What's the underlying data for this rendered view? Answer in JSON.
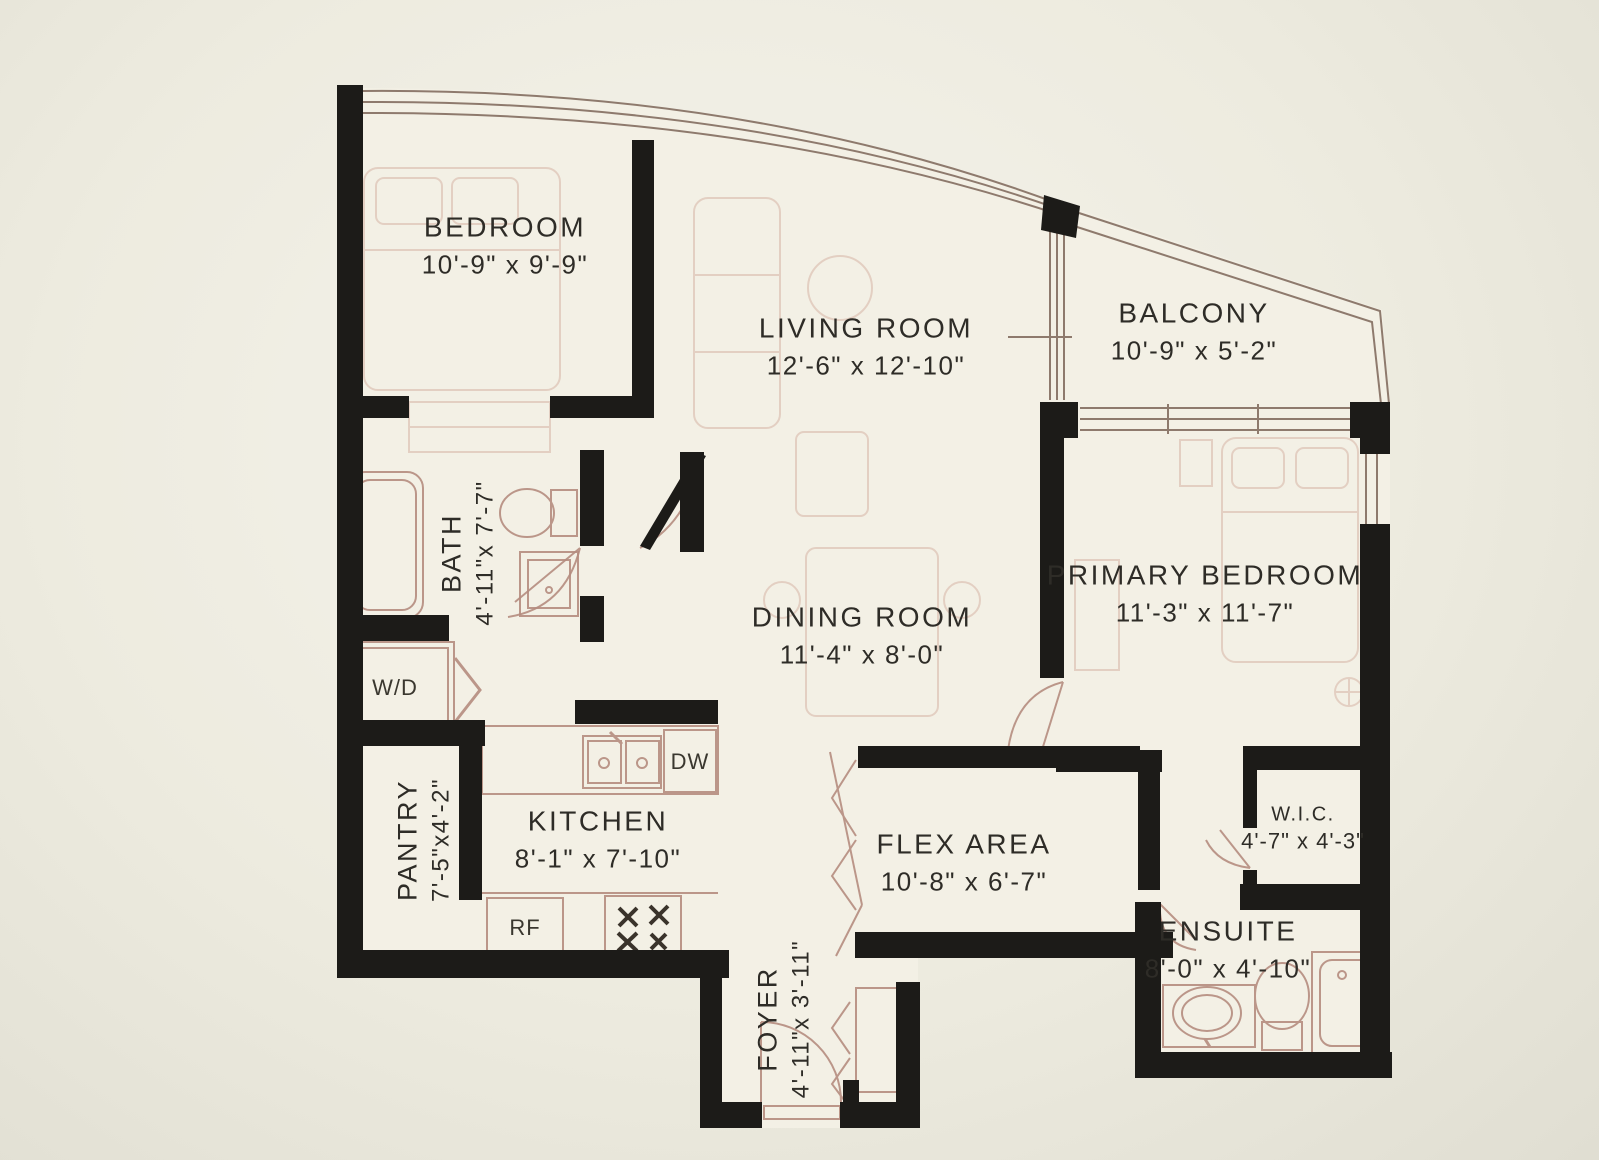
{
  "plan_title": "Apartment floor plan",
  "colors": {
    "wall": "#1c1b18",
    "thin_line": "#8e7a6d",
    "fixture_line": "#b58d80",
    "furniture_line": "#d6b5a6",
    "text": "#2e2c27",
    "background": "#edebdf",
    "floor": "#f3f0e5"
  },
  "rooms": [
    {
      "id": "bedroom",
      "name": "BEDROOM",
      "dims": "10'-9\" x 9'-9\"",
      "rotated": false
    },
    {
      "id": "living",
      "name": "LIVING ROOM",
      "dims": "12'-6\" x 12'-10\"",
      "rotated": false
    },
    {
      "id": "balcony",
      "name": "BALCONY",
      "dims": "10'-9\" x 5'-2\"",
      "rotated": false
    },
    {
      "id": "bath",
      "name": "BATH",
      "dims": "4'-11\"x 7'-7\"",
      "rotated": true
    },
    {
      "id": "primary",
      "name": "PRIMARY BEDROOM",
      "dims": "11'-3\" x 11'-7\"",
      "rotated": false
    },
    {
      "id": "dining",
      "name": "DINING ROOM",
      "dims": "11'-4\" x 8'-0\"",
      "rotated": false
    },
    {
      "id": "pantry",
      "name": "PANTRY",
      "dims": "7'-5\"x4'-2\"",
      "rotated": true
    },
    {
      "id": "kitchen",
      "name": "KITCHEN",
      "dims": "8'-1\" x 7'-10\"",
      "rotated": false
    },
    {
      "id": "flex",
      "name": "FLEX AREA",
      "dims": "10'-8\" x 6'-7\"",
      "rotated": false
    },
    {
      "id": "wic",
      "name": "W.I.C.",
      "dims": "4'-7\" x 4'-3\"",
      "rotated": false
    },
    {
      "id": "ensuite",
      "name": "ENSUITE",
      "dims": "8'-0\" x 4'-10\"",
      "rotated": false
    },
    {
      "id": "foyer",
      "name": "FOYER",
      "dims": "4'-11\"x 3'-11\"",
      "rotated": true
    }
  ],
  "appliances": [
    {
      "id": "wd",
      "label": "W/D"
    },
    {
      "id": "dw",
      "label": "DW"
    },
    {
      "id": "rf",
      "label": "RF"
    }
  ]
}
